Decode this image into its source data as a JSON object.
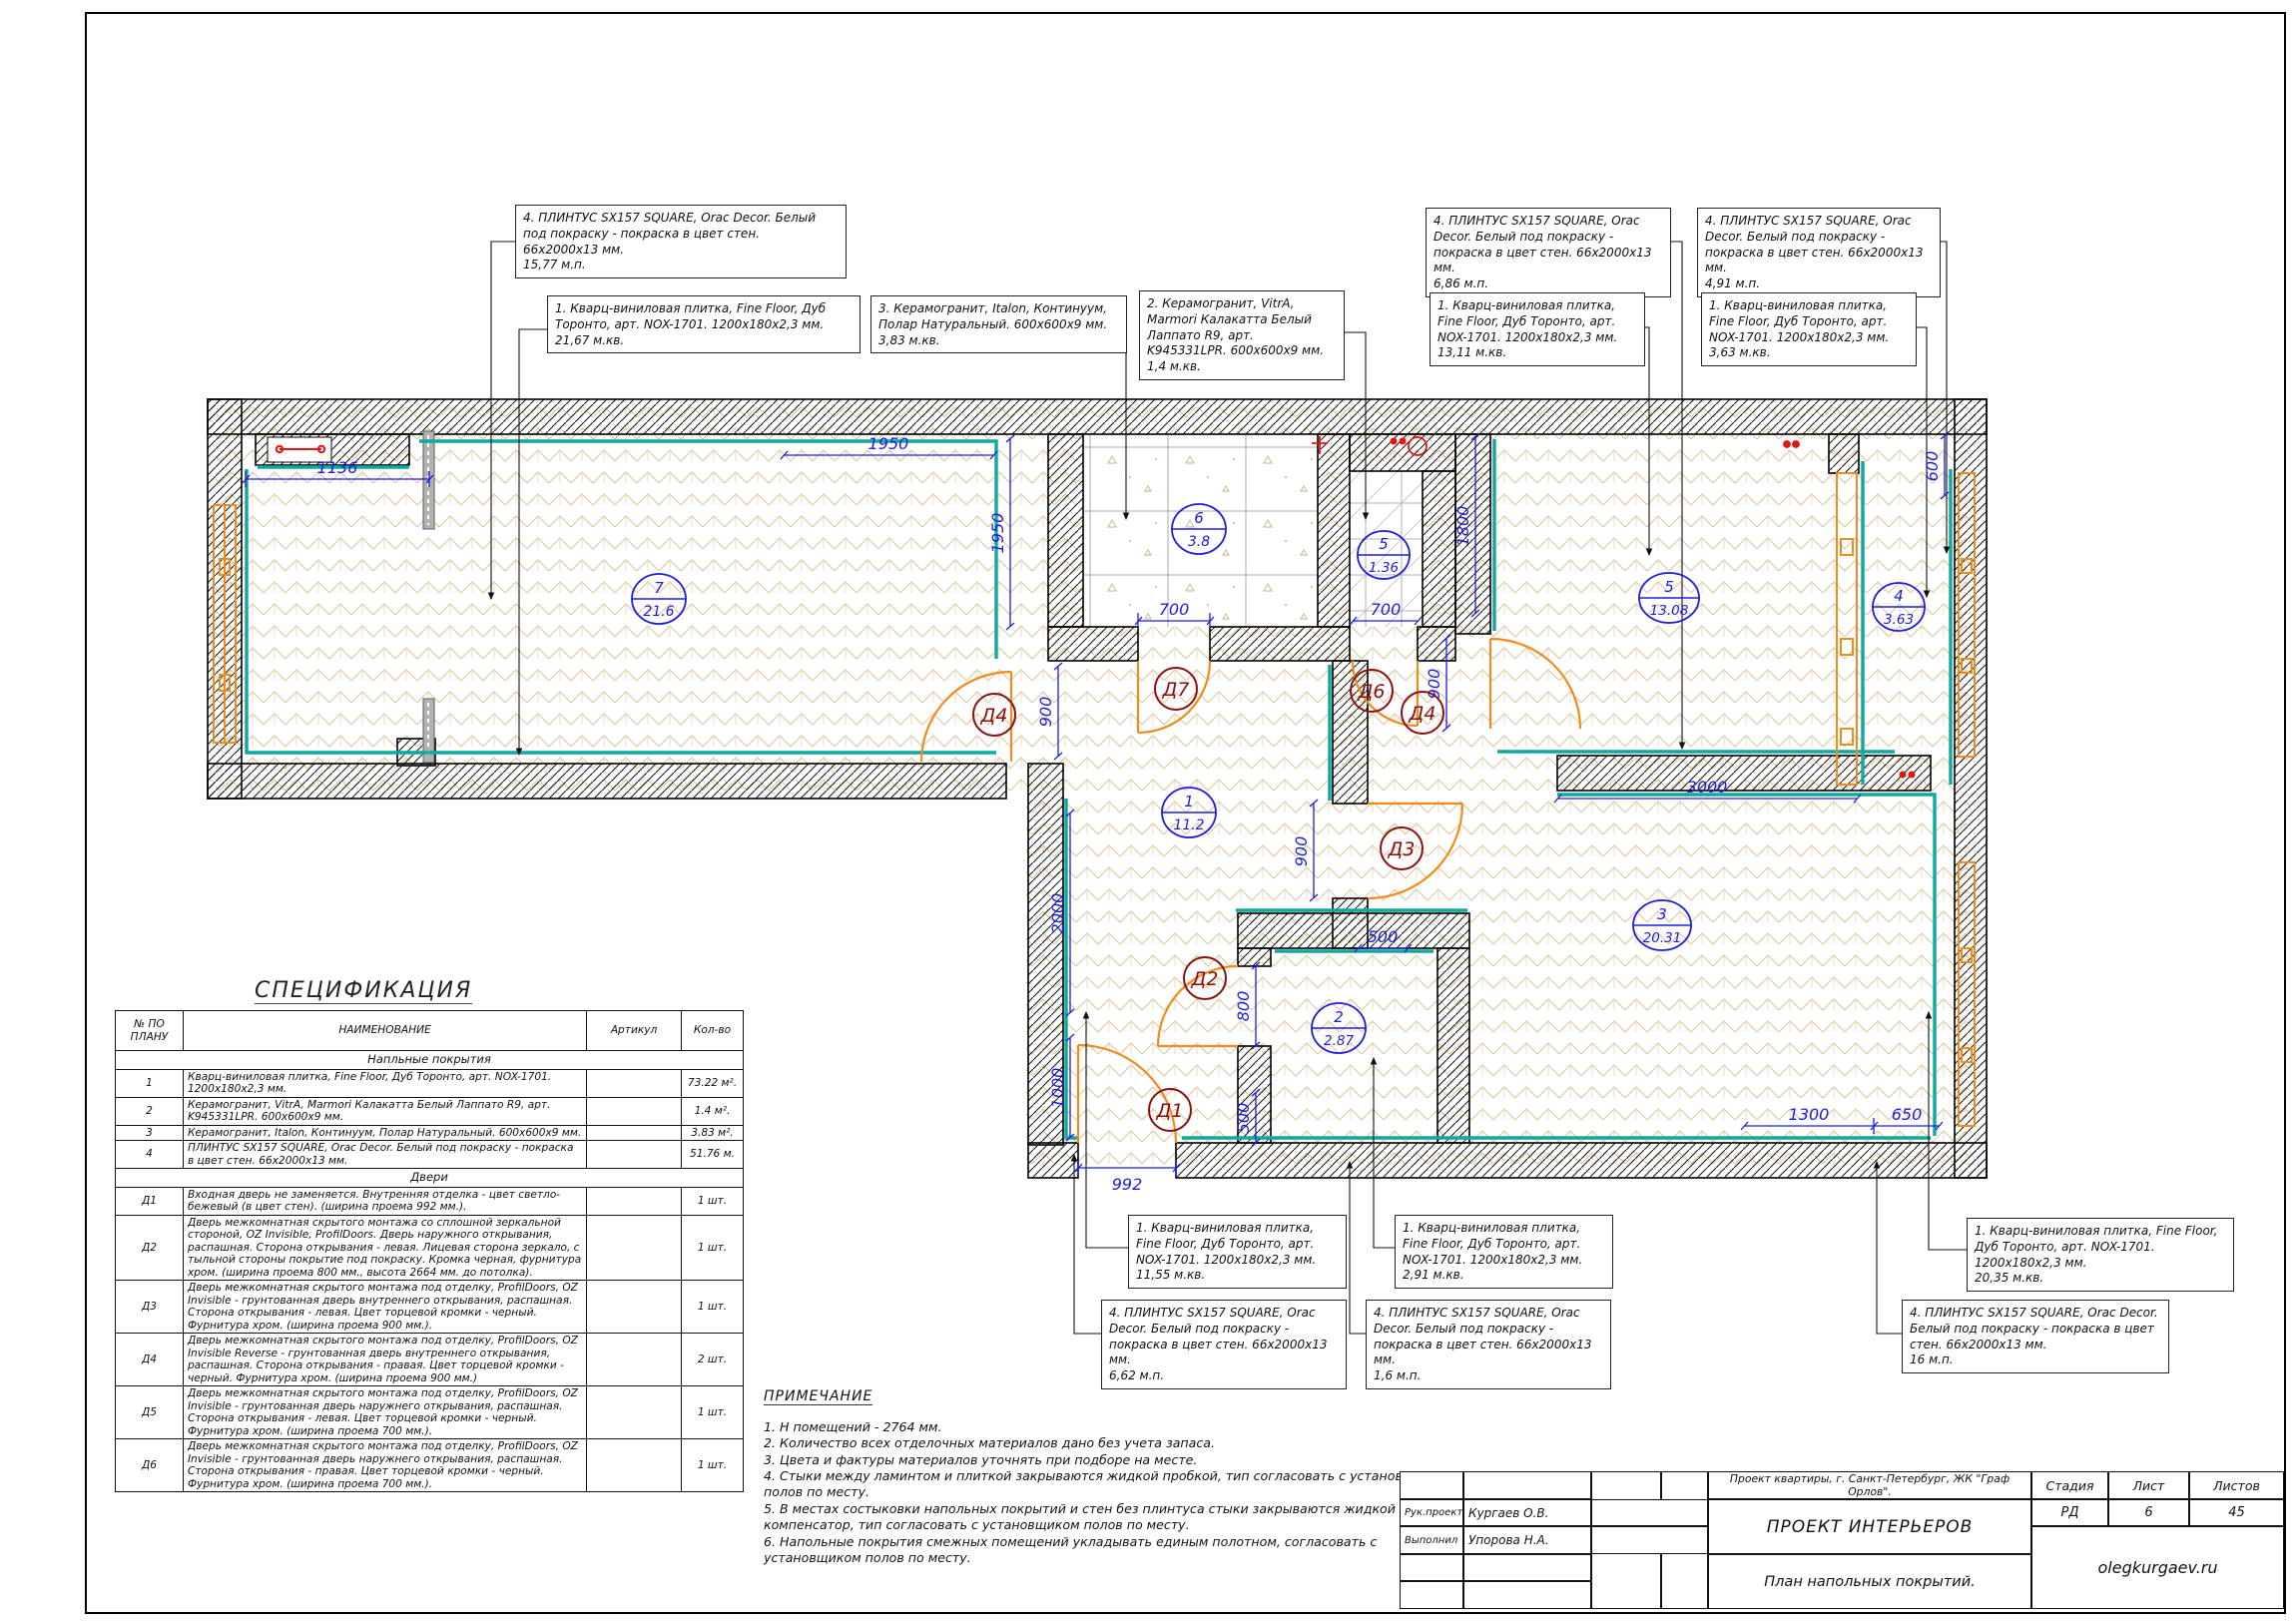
{
  "callouts": {
    "t1": {
      "text": "4. ПЛИНТУС SX157 SQUARE, Orac Decor. Белый под покраску - покраска в цвет стен. 66x2000x13 мм.",
      "qty": "15,77 м.п."
    },
    "t2": {
      "text": "1. Кварц-виниловая плитка, Fine Floor, Дуб Торонто, арт. NOX-1701. 1200x180x2,3 мм.",
      "qty": "21,67 м.кв."
    },
    "t3": {
      "text": "3. Керамогранит, Italon, Континуум, Полар Натуральный. 600x600x9 мм.",
      "qty": "3,83 м.кв."
    },
    "t4": {
      "text": "2. Керамогранит, VitrA, Marmori Калакатта Белый Лаппато R9, арт. K945331LPR. 600x600x9 мм.",
      "qty": "1,4 м.кв."
    },
    "t5": {
      "text": "4. ПЛИНТУС SX157 SQUARE, Orac Decor. Белый под покраску - покраска в цвет стен. 66x2000x13 мм.",
      "qty": "6,86 м.п."
    },
    "t6": {
      "text": "1. Кварц-виниловая плитка, Fine Floor, Дуб Торонто, арт. NOX-1701. 1200x180x2,3 мм.",
      "qty": "13,11 м.кв."
    },
    "t7": {
      "text": "4. ПЛИНТУС SX157 SQUARE, Orac Decor. Белый под покраску - покраска в цвет стен. 66x2000x13 мм.",
      "qty": "4,91 м.п."
    },
    "t8": {
      "text": "1. Кварц-виниловая плитка, Fine Floor, Дуб Торонто, арт. NOX-1701. 1200x180x2,3 мм.",
      "qty": "3,63 м.кв."
    },
    "b1": {
      "text": "1. Кварц-виниловая плитка, Fine Floor, Дуб Торонто, арт. NOX-1701. 1200x180x2,3 мм.",
      "qty": "11,55 м.кв."
    },
    "b2": {
      "text": "4. ПЛИНТУС SX157 SQUARE, Orac Decor. Белый под покраску - покраска в цвет стен. 66x2000x13 мм.",
      "qty": "6,62 м.п."
    },
    "b3": {
      "text": "1. Кварц-виниловая плитка, Fine Floor, Дуб Торонто, арт. NOX-1701. 1200x180x2,3 мм.",
      "qty": "2,91 м.кв."
    },
    "b4": {
      "text": "4. ПЛИНТУС SX157 SQUARE, Orac Decor. Белый под покраску - покраска в цвет стен. 66x2000x13 мм.",
      "qty": "1,6 м.п."
    },
    "b5": {
      "text": "1. Кварц-виниловая плитка, Fine Floor, Дуб Торонто, арт. NOX-1701. 1200x180x2,3 мм.",
      "qty": "20,35 м.кв."
    },
    "b6": {
      "text": "4. ПЛИНТУС SX157 SQUARE, Orac Decor. Белый под покраску - покраска в цвет стен. 66x2000x13 мм.",
      "qty": "16 м.п."
    }
  },
  "plan": {
    "rooms": {
      "r7": {
        "num": "7",
        "area": "21.6"
      },
      "r6": {
        "num": "6",
        "area": "3.8"
      },
      "r5s": {
        "num": "5",
        "area": "1.36"
      },
      "r5b": {
        "num": "5",
        "area": "13.08"
      },
      "r4": {
        "num": "4",
        "area": "3.63"
      },
      "r1": {
        "num": "1",
        "area": "11.2"
      },
      "r2": {
        "num": "2",
        "area": "2.87"
      },
      "r3": {
        "num": "3",
        "area": "20.31"
      }
    },
    "doors": {
      "d1": "Д1",
      "d2": "Д2",
      "d3": "Д3",
      "d4l": "Д4",
      "d4r": "Д4",
      "d6": "Д6",
      "d7": "Д7"
    },
    "dims": {
      "d1136": "1136",
      "d1950h": "1950",
      "d1950v": "1950",
      "d700a": "700",
      "d700b": "700",
      "d1800": "1800",
      "d600": "600",
      "d900a": "900",
      "d900b": "900",
      "d900c": "900",
      "d2000": "2000",
      "d1000": "1000",
      "d800": "800",
      "d500a": "500",
      "d500b": "500",
      "d992": "992",
      "d3000": "3000",
      "d1300": "1300",
      "d650": "650"
    },
    "colors": {
      "skirting": "#12a7a0",
      "dims": "#1d1de0",
      "door_label": "#8a1010",
      "accent": "#e81414",
      "window": "#f08c1e"
    }
  },
  "spec": {
    "title": "СПЕЦИФИКАЦИЯ",
    "headers": {
      "no": "№ ПО ПЛАНУ",
      "name": "НАИМЕНОВАНИЕ",
      "art": "Артикул",
      "qty": "Кол-во"
    },
    "section_floors": "Напльные покрытия",
    "section_doors": "Двери",
    "rows": [
      {
        "no": "1",
        "name": "Кварц-виниловая плитка, Fine Floor, Дуб Торонто, арт. NOX-1701. 1200x180x2,3 мм.",
        "art": "",
        "qty": "73.22 м²."
      },
      {
        "no": "2",
        "name": "Керамогранит, VitrA, Marmori Калакатта Белый Лаппато R9, арт. K945331LPR. 600x600x9 мм.",
        "art": "",
        "qty": "1.4 м²."
      },
      {
        "no": "3",
        "name": "Керамогранит, Italon, Континуум, Полар Натуральный. 600x600x9 мм.",
        "art": "",
        "qty": "3.83 м²."
      },
      {
        "no": "4",
        "name": "ПЛИНТУС SX157 SQUARE, Orac Decor. Белый под покраску - покраска в цвет стен. 66x2000x13 мм.",
        "art": "",
        "qty": "51.76 м."
      }
    ],
    "door_rows": [
      {
        "no": "Д1",
        "name": "Входная дверь не заменяется. Внутренняя отделка - цвет светло-бежевый (в цвет стен). (ширина проема 992 мм.).",
        "art": "",
        "qty": "1 шт."
      },
      {
        "no": "Д2",
        "name": "Дверь межкомнатная скрытого монтажа со сплошной зеркальной стороной, OZ Invisible, ProfilDoors. Дверь наружного открывания, распашная. Сторона открывания - левая. Лицевая сторона зеркало, с тыльной стороны покрытие под покраску. Кромка черная, фурнитура хром. (ширина проема 800 мм., высота 2664 мм. до потолка).",
        "art": "",
        "qty": "1 шт."
      },
      {
        "no": "Д3",
        "name": "Дверь межкомнатная скрытого монтажа под отделку, ProfilDoors, OZ Invisible - грунтованная дверь внутреннего открывания, распашная. Сторона открывания - левая. Цвет торцевой кромки - черный. Фурнитура хром. (ширина проема 900 мм.).",
        "art": "",
        "qty": "1 шт."
      },
      {
        "no": "Д4",
        "name": "Дверь межкомнатная скрытого монтажа под отделку, ProfilDoors, OZ Invisible Reverse - грунтованная дверь внутреннего открывания, распашная. Сторона открывания - правая. Цвет торцевой кромки - черный. Фурнитура хром. (ширина проема 900 мм.)",
        "art": "",
        "qty": "2 шт."
      },
      {
        "no": "Д5",
        "name": "Дверь межкомнатная скрытого монтажа под отделку, ProfilDoors, OZ Invisible - грунтованная дверь наружнего открывания, распашная. Сторона открывания - левая. Цвет торцевой кромки - черный. Фурнитура хром. (ширина проема 700 мм.).",
        "art": "",
        "qty": "1 шт."
      },
      {
        "no": "Д6",
        "name": "Дверь межкомнатная скрытого монтажа под отделку, ProfilDoors, OZ Invisible - грунтованная дверь наружнего открывания, распашная. Сторона открывания - правая. Цвет торцевой кромки - черный. Фурнитура хром. (ширина проема 700 мм.).",
        "art": "",
        "qty": "1 шт."
      }
    ]
  },
  "notes": {
    "title": "ПРИМЕЧАНИЕ",
    "items": [
      "1. Н помещений - 2764 мм.",
      "2. Количество всех отделочных материалов дано без учета запаса.",
      "3. Цвета и фактуры материалов уточнять при подборе на месте.",
      "4. Стыки между ламинтом и плиткой закрываются жидкой пробкой, тип согласовать с установщиком полов по месту.",
      "5. В местах состыковки напольных покрытий и стен без плинтуса стыки закрываются жидкой пробкой/компенсатор, тип согласовать с установщиком полов по месту.",
      "6. Напольные покрытия смежных помещений укладывать единым полотном, согласовать с установщиком полов по месту."
    ]
  },
  "titleblock": {
    "project": "Проект квартиры, г. Санкт-Петербург, ЖК \"Граф Орлов\".",
    "stage_label": "Стадия",
    "sheet_label": "Лист",
    "sheets_label": "Листов",
    "stage": "РД",
    "sheet": "6",
    "sheets": "45",
    "role1": "Рук.проекта",
    "name1": "Кургаев О.В.",
    "role2": "Выполнил",
    "name2": "Упорова Н.А.",
    "title_main": "ПРОЕКТ ИНТЕРЬЕРОВ",
    "title_sub": "План напольных покрытий.",
    "site": "olegkurgaev.ru"
  }
}
